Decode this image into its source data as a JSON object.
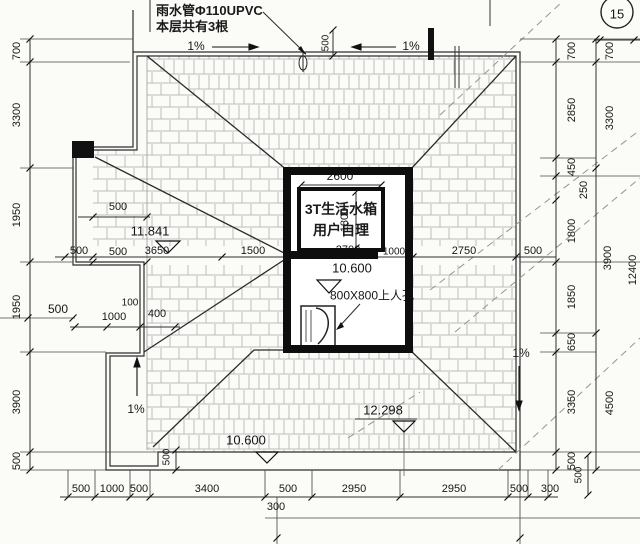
{
  "note": {
    "line1": "雨水管Φ110UPVC",
    "line2": "本层共有3根"
  },
  "bubble": {
    "number": "15"
  },
  "tank": {
    "line1": "3T生活水箱",
    "line2": "用户自理"
  },
  "levels": {
    "wing": "11.841",
    "inner": "10.600",
    "hip": "12.298",
    "eave": "10.600"
  },
  "hatch": {
    "label": "800X800上人孔"
  },
  "slopes": {
    "top_left": "1%",
    "top_right": "1%",
    "bottom_left": "1%",
    "right": "1%"
  },
  "dims": {
    "left": [
      "700",
      "3300",
      "1950",
      "1950",
      "3900",
      "500"
    ],
    "right_inner": [
      "700",
      "2850",
      "450",
      "250",
      "1800",
      "1850",
      "650",
      "3350",
      "500"
    ],
    "right_outer": [
      "700",
      "3300",
      "3900",
      "4500"
    ],
    "right_total": "12400",
    "bottom": [
      "500",
      "1000",
      "500",
      "3400",
      "500",
      "2950",
      "2950",
      "500",
      "300"
    ],
    "bottom_step": "300",
    "bottom_right_v": "500",
    "bottom_left_v": "500",
    "ridge": [
      "500",
      "3650",
      "1500",
      "2700",
      "1000",
      "2750",
      "500"
    ],
    "tank_width": "2600",
    "tank_height": "1800",
    "top_offset": "500",
    "wing": [
      "500",
      "500"
    ],
    "left_offset": "500",
    "step": [
      "100",
      "1000",
      "400"
    ]
  }
}
